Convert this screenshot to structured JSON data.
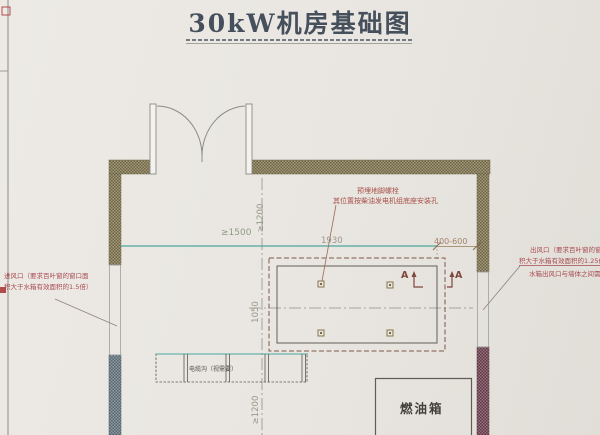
{
  "title": "30kW机房基础图",
  "notes": {
    "inlet_line1": "进风口（要求百叶窗的窗口面",
    "inlet_line2": "积大于水箱有效面积的1.5倍）",
    "outlet_line1": "出风口（要求百叶窗的窗口面",
    "outlet_line2": "积大于水箱有效面积的1.25倍）",
    "outlet_line3": "水箱出风口与墙体之间需装导风",
    "bolt_line1": "预埋地脚螺栓",
    "bolt_line2": "其位置按柴油发电机组底座安装孔"
  },
  "dimensions": {
    "front_clearance": "≥1500",
    "foundation_length": "1930",
    "rear_clearance": "400-600",
    "top_clearance": "≥1200",
    "foundation_width": "1050",
    "bottom_clearance": "≥1200"
  },
  "labels": {
    "cable_trench": "电缆沟（视需要）",
    "fuel_tank": "燃油箱",
    "section_left": "A",
    "section_right": "A"
  },
  "colors": {
    "paper": "#e9e6e1",
    "title_ink": "#46505c",
    "wall_olive": "#837a58",
    "wall_blue": "#6e7e88",
    "wall_maroon": "#7c5260",
    "note_red": "#a84a52",
    "dim_teal": "#49a79c",
    "line_ink": "#5c5c55"
  }
}
